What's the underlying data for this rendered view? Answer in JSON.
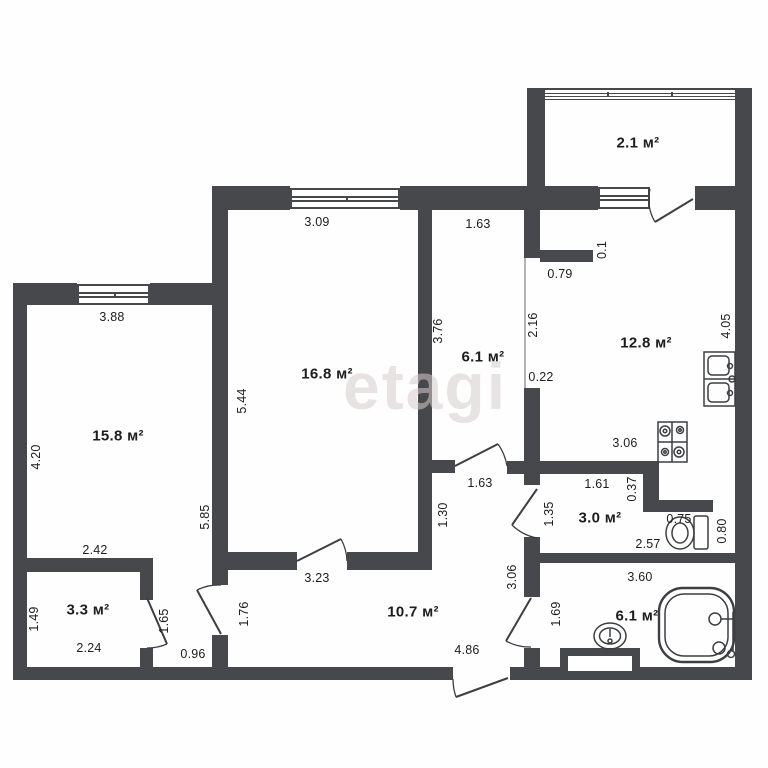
{
  "plan": {
    "watermark": "etagi",
    "wall_color": "#46484b",
    "text_color": "#1d1d1f",
    "rooms": [
      {
        "id": "balcony",
        "label": "2.1 м²"
      },
      {
        "id": "kitchen",
        "label": "12.8 м²"
      },
      {
        "id": "corridor",
        "label": "6.1 м²"
      },
      {
        "id": "living-room",
        "label": "16.8 м²"
      },
      {
        "id": "bedroom",
        "label": "15.8 м²"
      },
      {
        "id": "toilet",
        "label": "3.0 м²"
      },
      {
        "id": "storage",
        "label": "3.3 м²"
      },
      {
        "id": "hallway",
        "label": "10.7 м²"
      },
      {
        "id": "bathroom",
        "label": "6.1 м²"
      }
    ],
    "dims": [
      {
        "value": "3.09"
      },
      {
        "value": "1.63"
      },
      {
        "value": "0.79"
      },
      {
        "value": "0.1"
      },
      {
        "value": "3.88"
      },
      {
        "value": "2.16"
      },
      {
        "value": "3.76"
      },
      {
        "value": "4.05"
      },
      {
        "value": "5.44"
      },
      {
        "value": "0.22"
      },
      {
        "value": "4.20"
      },
      {
        "value": "3.06"
      },
      {
        "value": "5.85"
      },
      {
        "value": "1.63"
      },
      {
        "value": "1.61"
      },
      {
        "value": "0.37"
      },
      {
        "value": "1.30"
      },
      {
        "value": "1.35"
      },
      {
        "value": "0.75"
      },
      {
        "value": "0.80"
      },
      {
        "value": "2.42"
      },
      {
        "value": "2.57"
      },
      {
        "value": "3.23"
      },
      {
        "value": "3.06"
      },
      {
        "value": "3.60"
      },
      {
        "value": "1.49"
      },
      {
        "value": "1.65"
      },
      {
        "value": "1.76"
      },
      {
        "value": "1.69"
      },
      {
        "value": "2.24"
      },
      {
        "value": "0.96"
      },
      {
        "value": "4.86"
      }
    ],
    "fixtures": [
      {
        "id": "balcony-glazing"
      },
      {
        "id": "kitchen-sink"
      },
      {
        "id": "stove"
      },
      {
        "id": "toilet-wc"
      },
      {
        "id": "washbasin"
      },
      {
        "id": "bathtub"
      },
      {
        "id": "vent-niche"
      }
    ]
  }
}
